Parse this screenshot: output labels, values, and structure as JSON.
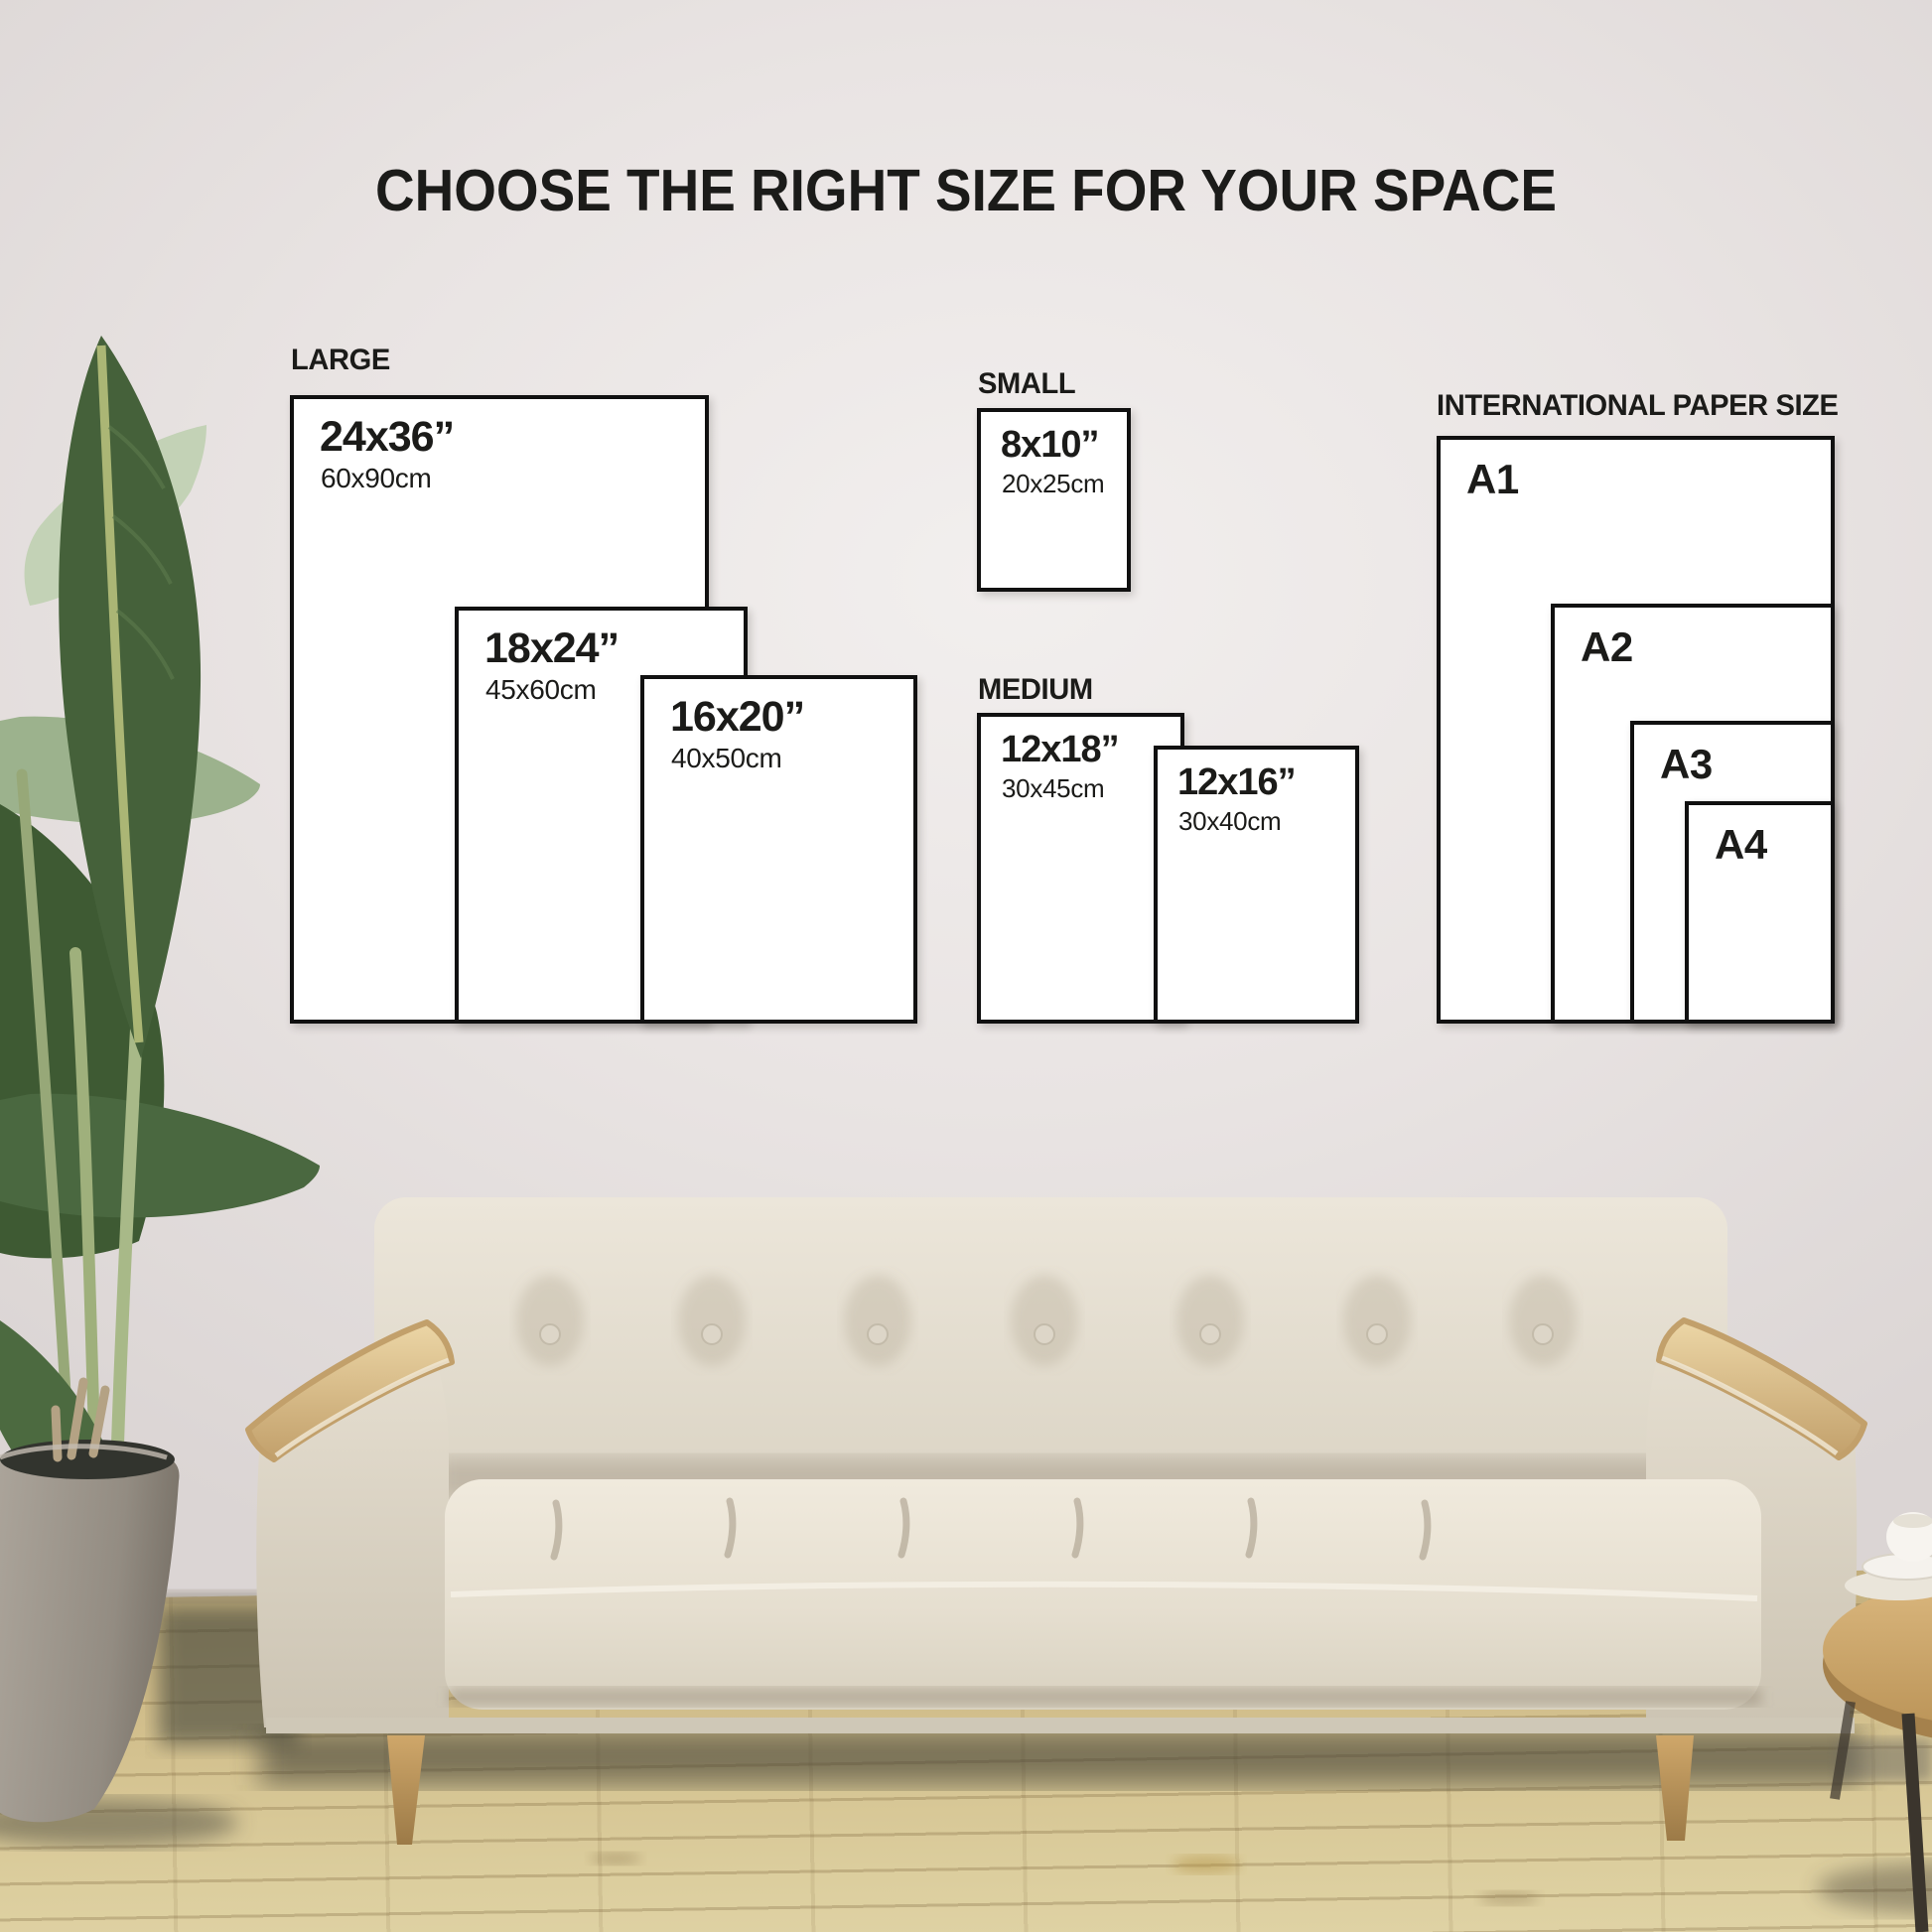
{
  "title": "CHOOSE THE RIGHT SIZE FOR YOUR SPACE",
  "groups": {
    "large": {
      "label": "LARGE",
      "items": {
        "s2436": {
          "inches": "24x36”",
          "cm": "60x90cm"
        },
        "s1824": {
          "inches": "18x24”",
          "cm": "45x60cm"
        },
        "s1620": {
          "inches": "16x20”",
          "cm": "40x50cm"
        }
      }
    },
    "small": {
      "label": "SMALL",
      "items": {
        "s810": {
          "inches": "8x10”",
          "cm": "20x25cm"
        }
      }
    },
    "medium": {
      "label": "MEDIUM",
      "items": {
        "s1218": {
          "inches": "12x18”",
          "cm": "30x45cm"
        },
        "s1216": {
          "inches": "12x16”",
          "cm": "30x40cm"
        }
      }
    },
    "international": {
      "label": "INTERNATIONAL PAPER SIZE",
      "items": {
        "a1": {
          "name": "A1"
        },
        "a2": {
          "name": "A2"
        },
        "a3": {
          "name": "A3"
        },
        "a4": {
          "name": "A4"
        }
      }
    }
  },
  "theme": {
    "wall-light": "#f2efee",
    "wall": "#e9e4e3",
    "wall-dark": "#dbd5d4",
    "text": "#1b1b19",
    "box-border": "#101010",
    "box-fill": "#ffffff",
    "floor": "#cfbb88",
    "floor-light": "#dcce9e",
    "plank-line": "rgba(118,94,54,0.28)"
  }
}
